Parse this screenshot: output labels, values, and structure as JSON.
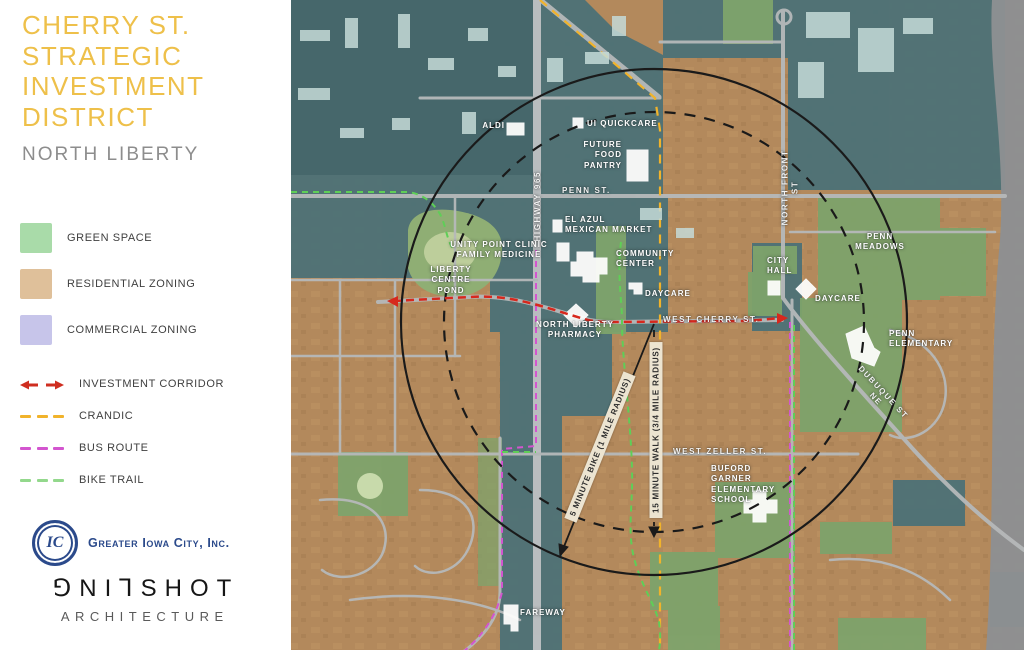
{
  "page": {
    "title": "CHERRY ST.\nSTRATEGIC\nINVESTMENT\nDISTRICT",
    "subtitle": "NORTH LIBERTY"
  },
  "legend": {
    "items": [
      {
        "label": "GREEN SPACE",
        "type": "swatch",
        "color": "#a9dba9"
      },
      {
        "label": "RESIDENTIAL ZONING",
        "type": "swatch",
        "color": "#dfc09a"
      },
      {
        "label": "COMMERCIAL ZONING",
        "type": "swatch",
        "color": "#c7c5ea"
      },
      {
        "label": "INVESTMENT CORRIDOR",
        "type": "double-arrow",
        "color": "#cf2e20"
      },
      {
        "label": "CRANDIC",
        "type": "dash",
        "color": "#f1b32b"
      },
      {
        "label": "BUS ROUTE",
        "type": "dash",
        "color": "#d355cf"
      },
      {
        "label": "BIKE TRAIL",
        "type": "dash",
        "color": "#93d88c"
      }
    ]
  },
  "logos": {
    "gic_monogram": "IC",
    "gic_name": "Greater Iowa City, Inc.",
    "slingshot_word": "⅁NI⅂SHOT",
    "slingshot_sub": "ARCHITECTURE"
  },
  "map": {
    "streets": {
      "penn": "PENN ST.",
      "highway": "HIGHWAY 965",
      "cherry": "WEST CHERRY ST.",
      "front": "NORTH FRONT ST",
      "zeller": "WEST ZELLER ST.",
      "dubuque": "DUBUQUE ST NE"
    },
    "places": {
      "aldi": "ALDI",
      "quickcare": "UI QUICKCARE",
      "pantry": "FUTURE\nFOOD\nPANTRY",
      "elazul": "EL AZUL\nMEXICAN MARKET",
      "unity": "UNITY POINT CLINIC\nFAMILY MEDICINE",
      "community": "COMMUNITY\nCENTER",
      "pond": "LIBERTY\nCENTRE\nPOND",
      "daycare_west": "DAYCARE",
      "pharmacy": "NORTH LIBERTY\nPHARMACY",
      "cityhall": "CITY\nHALL",
      "daycare_east": "DAYCARE",
      "penn_meadows": "PENN\nMEADOWS",
      "penn_elementary": "PENN\nELEMENTARY",
      "buford": "BUFORD\nGARNER\nELEMENTARY\nSCHOOL",
      "fareway": "FAREWAY"
    },
    "annotations": {
      "bike_radius": "5 MINUTE BIKE (1 MILE RADIUS)",
      "walk_radius": "15 MINUTE WALK (3/4 MILE RADIUS)"
    }
  },
  "colors": {
    "title_gold": "#eec04a",
    "subtitle_gray": "#8d8d8d",
    "commercial_overlay_teal": "#4e7276",
    "residential_tan": "#b3895c",
    "green_space": "#7ea36b",
    "investment_red": "#d7281d",
    "crandic_yellow": "#f1b32b",
    "bus_magenta": "#d355cf",
    "bike_green": "#5fce57",
    "gic_blue": "#2b4a8b"
  }
}
